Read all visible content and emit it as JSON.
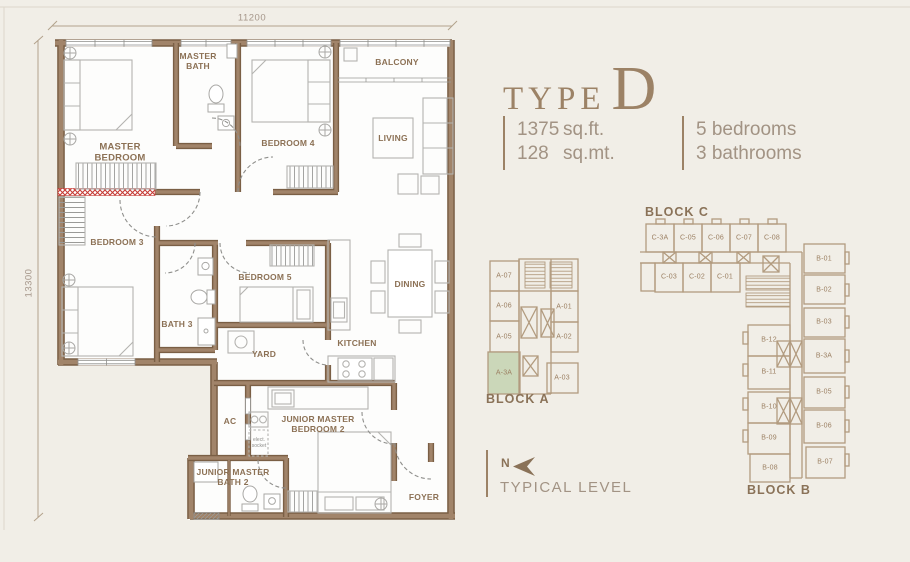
{
  "header": {
    "title_prefix": "TYPE",
    "title_letter": "D",
    "area": {
      "ft_value": "1375",
      "ft_unit": "sq.ft.",
      "mt_value": "128",
      "mt_unit": "sq.mt."
    },
    "summary": {
      "bedrooms": "5 bedrooms",
      "bathrooms": "3 bathrooms"
    }
  },
  "floorplan": {
    "dimensions": {
      "width_label": "11200",
      "height_label": "13300"
    },
    "rooms": {
      "master_bedroom": "MASTER BEDROOM",
      "master_bath": "MASTER BATH",
      "bedroom4": "BEDROOM 4",
      "balcony": "BALCONY",
      "living": "LIVING",
      "bedroom3": "BEDROOM 3",
      "bath3": "BATH 3",
      "bedroom5": "BEDROOM 5",
      "dining": "DINING",
      "yard": "YARD",
      "kitchen": "KITCHEN",
      "ac": "AC",
      "junior_master_bedroom2": "JUNIOR MASTER BEDROOM 2",
      "junior_master_bath2": "JUNIOR MASTER BATH 2",
      "foyer": "FOYER",
      "socket_note": "elect. socket"
    }
  },
  "compass": {
    "north_label": "N",
    "level_label": "TYPICAL LEVEL"
  },
  "blocks": {
    "a": {
      "label": "BLOCK A",
      "highlight_unit": "A-3A",
      "units": [
        "A-07",
        "A-06",
        "A-05",
        "A-3A",
        "A-01",
        "A-02",
        "A-03"
      ]
    },
    "c": {
      "label": "BLOCK C",
      "units": [
        "C-3A",
        "C-05",
        "C-06",
        "C-07",
        "C-08",
        "C-03",
        "C-02",
        "C-01"
      ]
    },
    "b": {
      "label": "BLOCK B",
      "units": [
        "B-01",
        "B-02",
        "B-03",
        "B-3A",
        "B-05",
        "B-06",
        "B-07",
        "B-12",
        "B-11",
        "B-10",
        "B-09",
        "B-08"
      ]
    }
  },
  "colors": {
    "background": "#f1eee7",
    "plan_interior": "#fdfdfc",
    "wall": "#a1846a",
    "wall_edge": "#7a5f45",
    "label_text": "#8c7155",
    "accent_title": "#9c8266",
    "highlight_green": "#cbd7b9",
    "alarm_red": "#c63b35",
    "block_outline": "#b29b7f"
  }
}
